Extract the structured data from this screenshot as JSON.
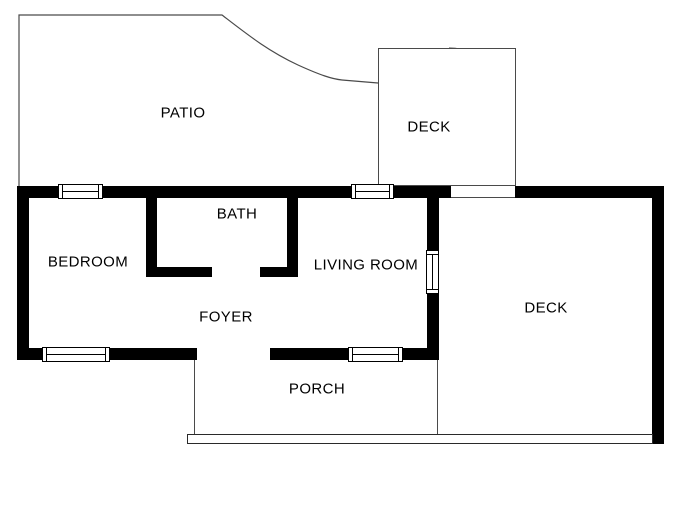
{
  "canvas": {
    "width": 683,
    "height": 512,
    "background": "#ffffff"
  },
  "colors": {
    "wall": "#000000",
    "thin_line": "#4a4a4a",
    "text": "#000000"
  },
  "rooms": {
    "patio": {
      "label": "PATIO"
    },
    "upper_deck": {
      "label": "DECK"
    },
    "bedroom": {
      "label": "BEDROOM"
    },
    "bath": {
      "label": "BATH"
    },
    "living_room": {
      "label": "LIVING ROOM"
    },
    "foyer": {
      "label": "FOYER"
    },
    "porch": {
      "label": "PORCH"
    },
    "side_deck": {
      "label": "DECK"
    }
  },
  "icons": {
    "spiral_staircase_icon": "quarter-turn spiral stair fan with clockwise direction arrow"
  }
}
